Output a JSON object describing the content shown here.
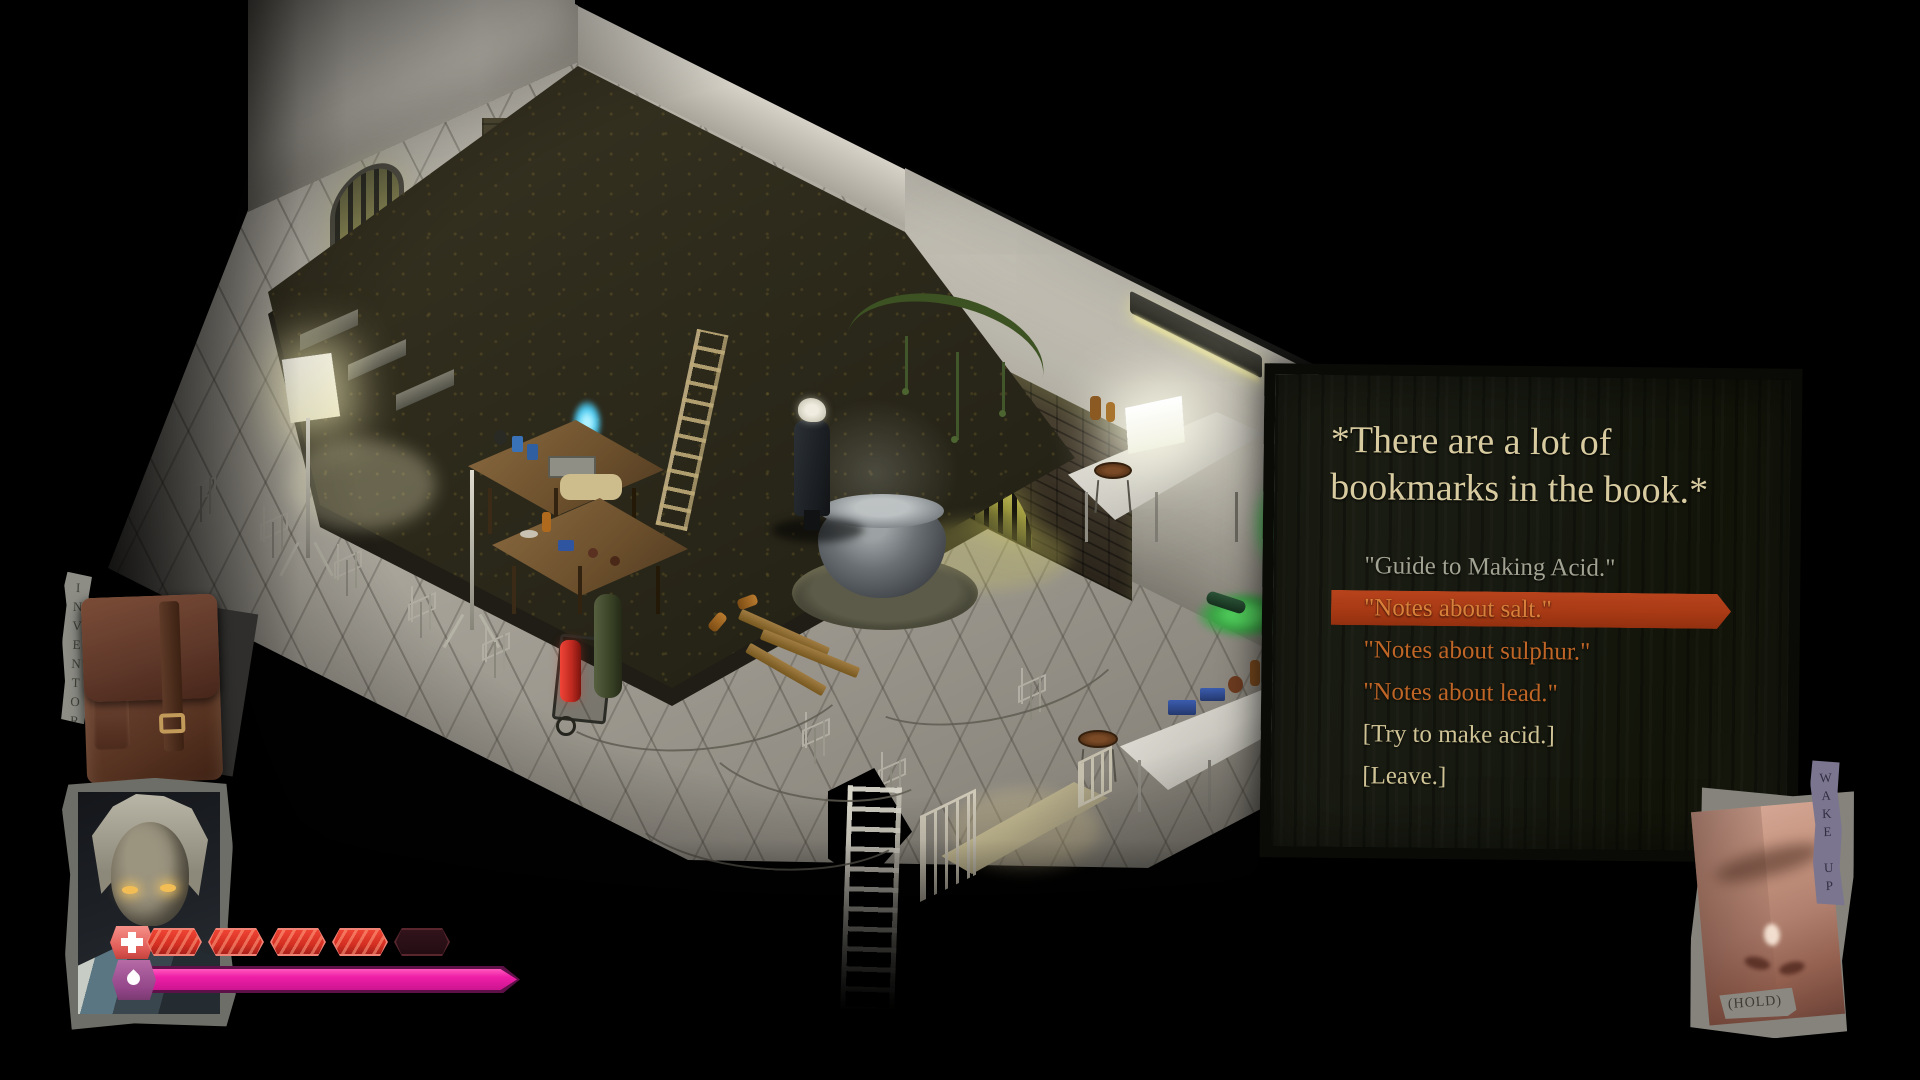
{
  "dialogue": {
    "narration_line1": "*There are a lot of",
    "narration_line2": "bookmarks in the book.*",
    "options": [
      {
        "label": "\"Guide to Making Acid.\"",
        "state": "visited"
      },
      {
        "label": "\"Notes about salt.\"",
        "state": "selected"
      },
      {
        "label": "\"Notes about sulphur.\"",
        "state": "unread"
      },
      {
        "label": "\"Notes about lead.\"",
        "state": "unread"
      },
      {
        "label": "[Try to make acid.]",
        "state": "action"
      },
      {
        "label": "[Leave.]",
        "state": "action"
      }
    ]
  },
  "hud": {
    "inventory_label": "INVENTORY",
    "wake_up_label": "WAKE UP",
    "wake_up_hint": "(HOLD)",
    "health": {
      "icon": "plus-icon",
      "segments_total": 5,
      "segments_filled": 4
    },
    "droplet_bar": {
      "icon": "droplet-icon",
      "fill_percent": 100
    }
  },
  "colors": {
    "dialogue_highlight": "#a83a15",
    "narration_text": "#d8cba0",
    "visited_option": "#a3a393",
    "unread_option": "#bf6526",
    "selected_option": "#d9813a",
    "action_option": "#d0c496",
    "health_filled": "#d42f22",
    "health_empty": "#2a1016",
    "droplet_fill": "#ee1fa7"
  }
}
